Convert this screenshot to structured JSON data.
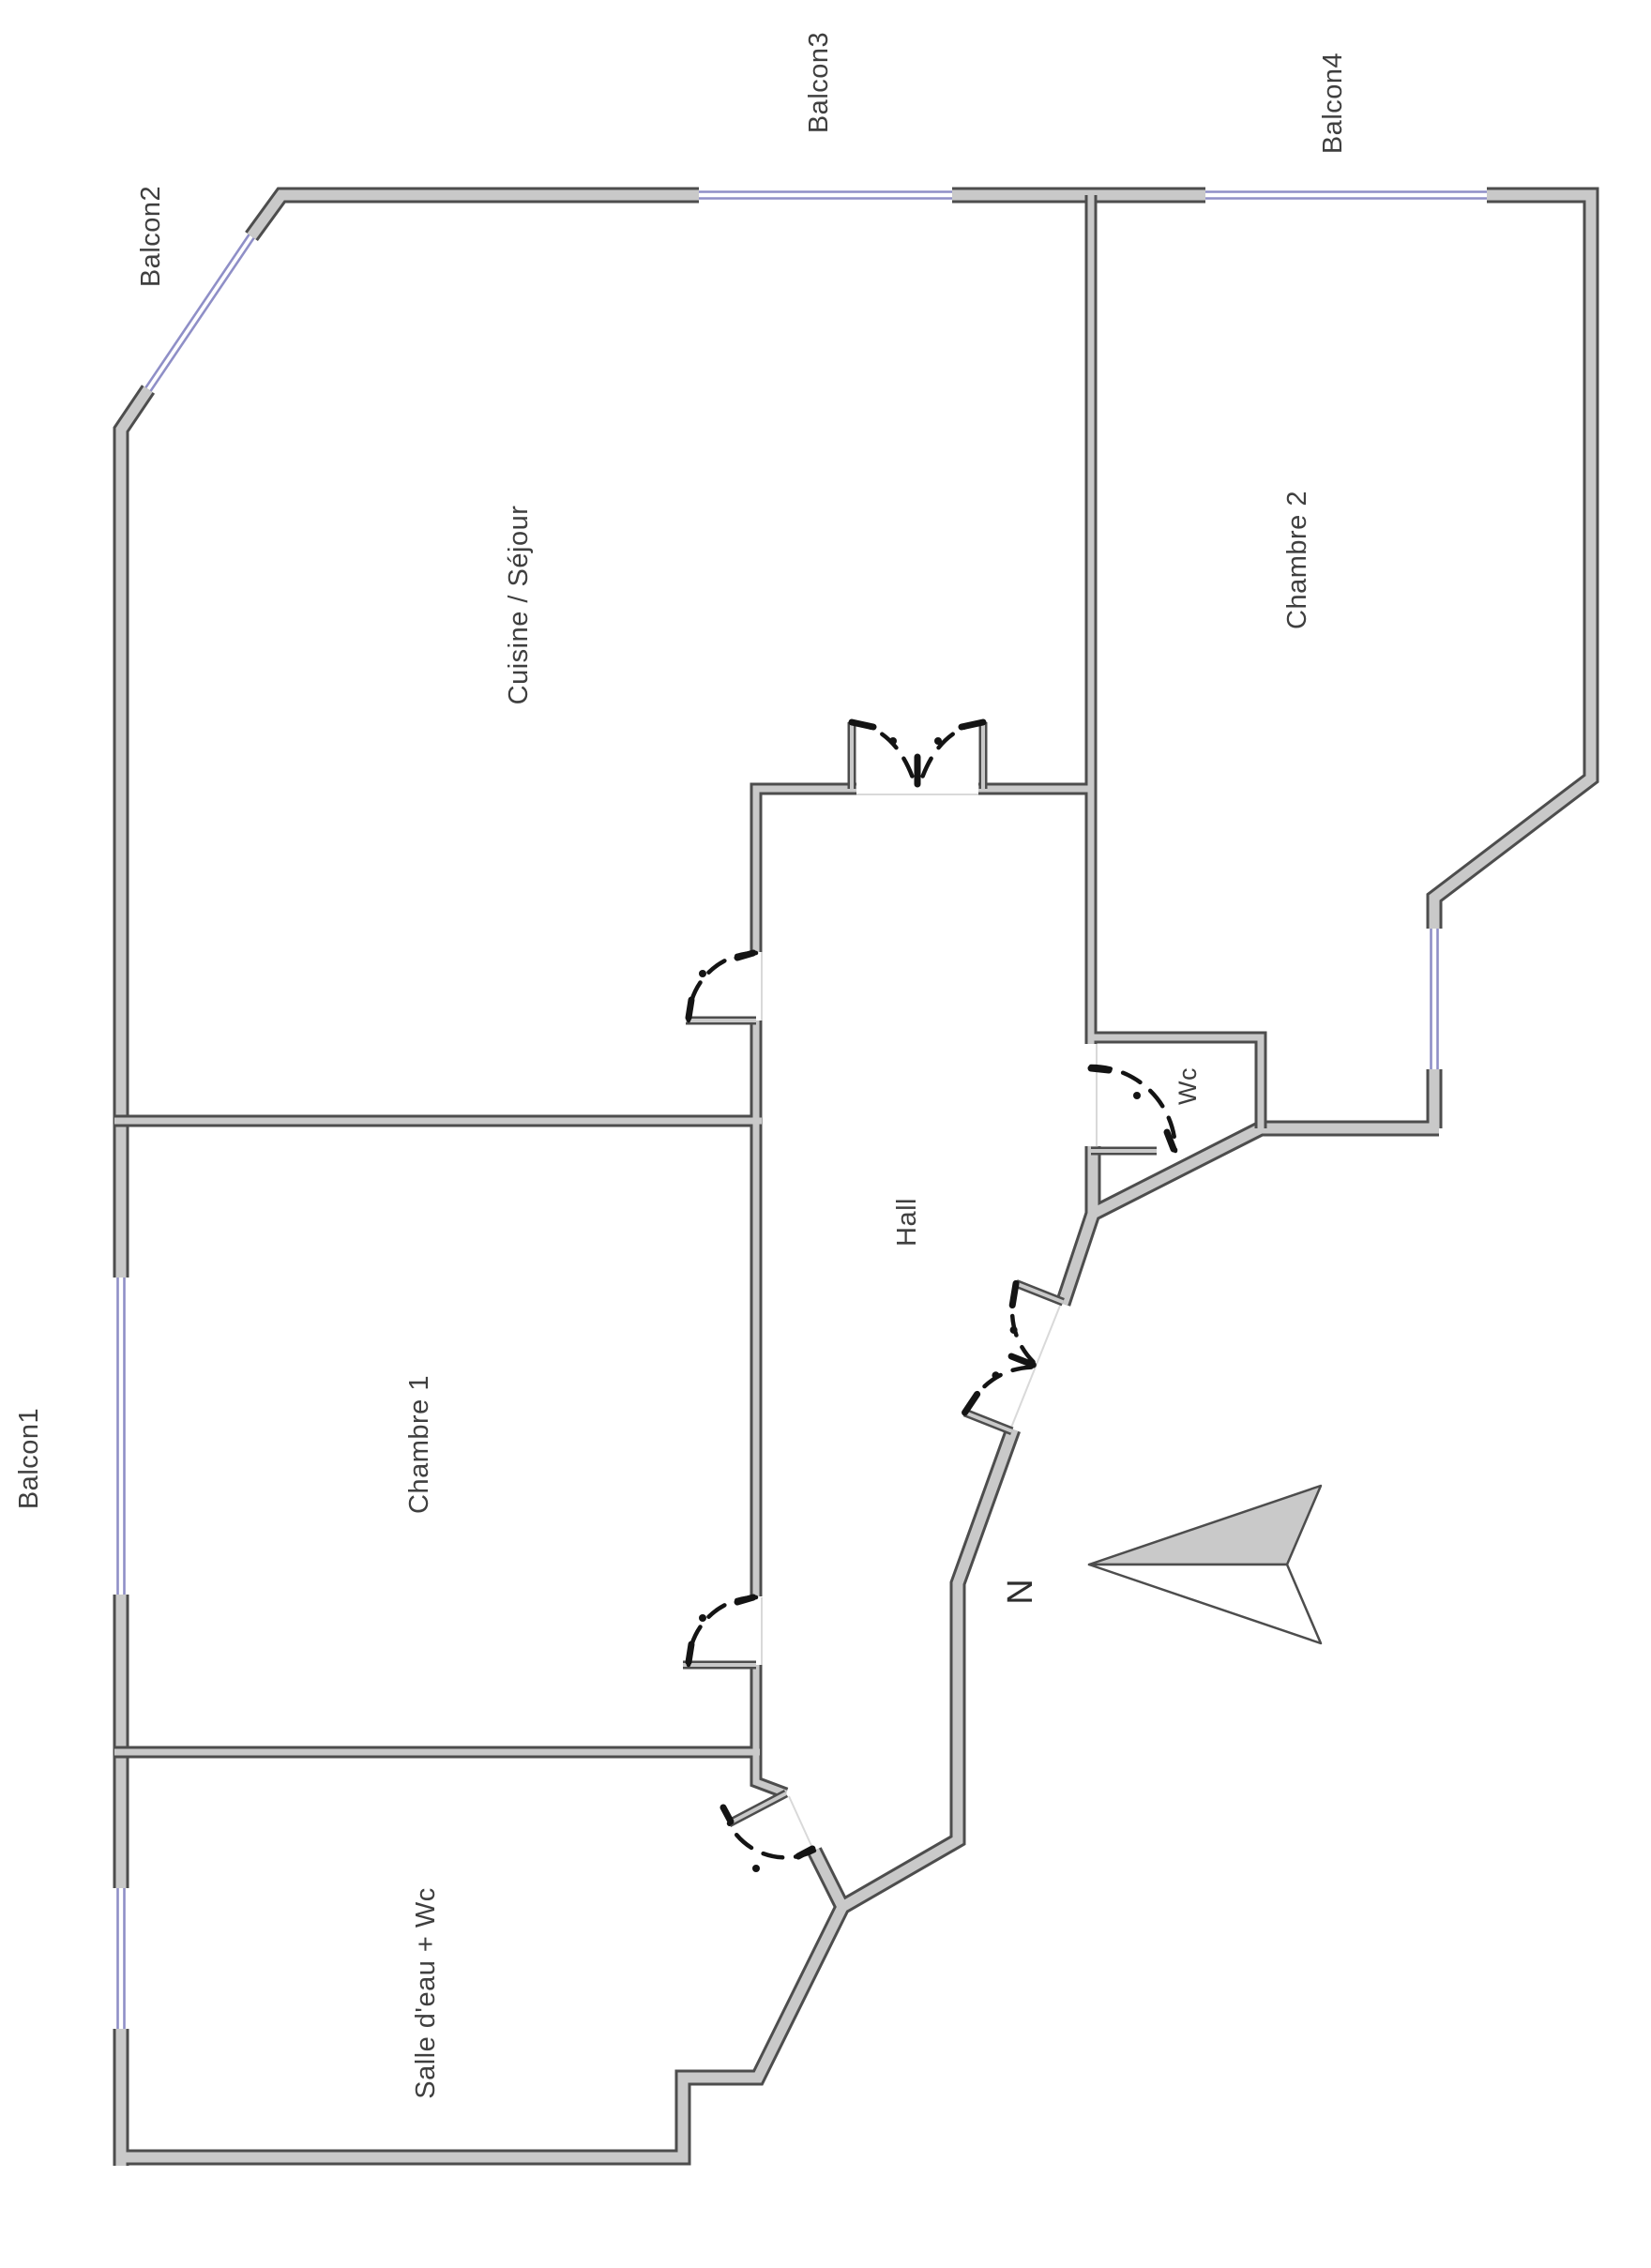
{
  "rooms": {
    "cuisine_sejour": "Cuisine / Séjour",
    "chambre1": "Chambre 1",
    "chambre2": "Chambre 2",
    "hall": "Hall",
    "wc": "Wc",
    "salle_deau": "Salle d'eau + Wc"
  },
  "balconies": {
    "balcon1": "Balcon1",
    "balcon2": "Balcon2",
    "balcon3": "Balcon3",
    "balcon4": "Balcon4"
  },
  "compass": {
    "north": "N"
  },
  "colors": {
    "background": "#ffffff",
    "wall_fill": "#c9c9c9",
    "wall_outline": "#4d4d4d",
    "window": "#8f8fc7",
    "door": "#141414",
    "label": "#3f3f3f"
  }
}
